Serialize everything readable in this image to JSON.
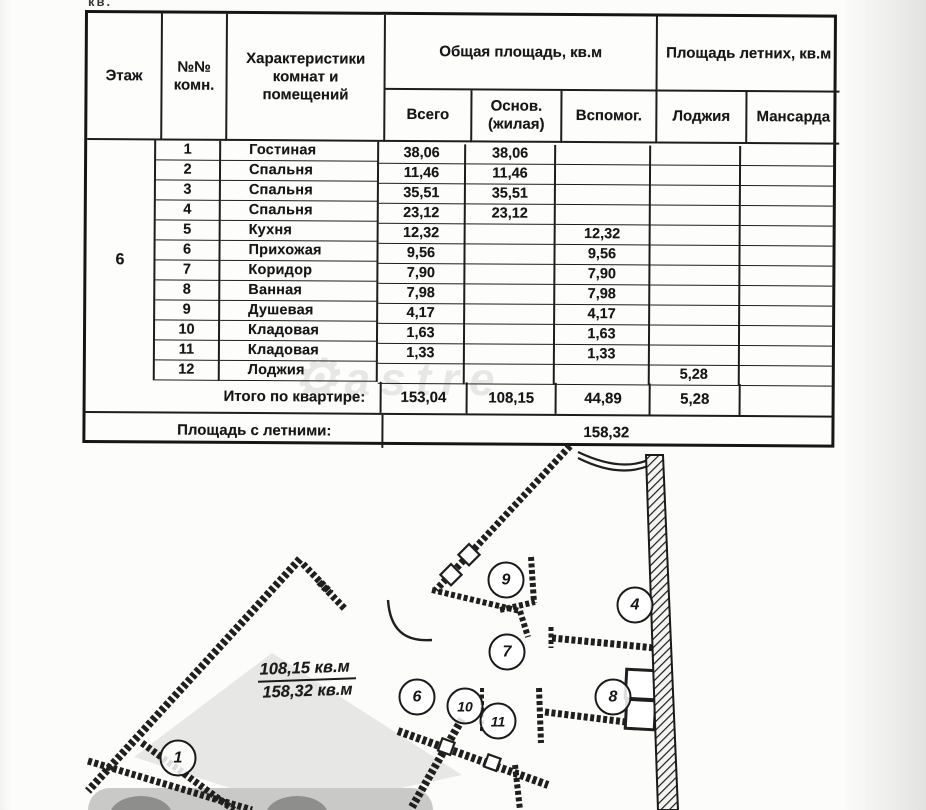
{
  "page": {
    "top_fragment": "кв.",
    "watermark_text": "astre"
  },
  "table": {
    "headers": {
      "floor": "Этаж",
      "room_no": "№№ комн.",
      "characteristics": "Характеристики комнат и помещений",
      "total_area_group": "Общая площадь, кв.м",
      "summer_area_group": "Площадь летних, кв.м",
      "total": "Всего",
      "main": "Основ. (жилая)",
      "auxiliary": "Вспомог.",
      "loggia": "Лоджия",
      "mansard": "Мансарда"
    },
    "floor_value": "6",
    "rows": [
      {
        "no": "1",
        "name": "Гостиная",
        "total": "38,06",
        "main": "38,06",
        "aux": "",
        "loggia": "",
        "mansard": ""
      },
      {
        "no": "2",
        "name": "Спальня",
        "total": "11,46",
        "main": "11,46",
        "aux": "",
        "loggia": "",
        "mansard": ""
      },
      {
        "no": "3",
        "name": "Спальня",
        "total": "35,51",
        "main": "35,51",
        "aux": "",
        "loggia": "",
        "mansard": ""
      },
      {
        "no": "4",
        "name": "Спальня",
        "total": "23,12",
        "main": "23,12",
        "aux": "",
        "loggia": "",
        "mansard": ""
      },
      {
        "no": "5",
        "name": "Кухня",
        "total": "12,32",
        "main": "",
        "aux": "12,32",
        "loggia": "",
        "mansard": ""
      },
      {
        "no": "6",
        "name": "Прихожая",
        "total": "9,56",
        "main": "",
        "aux": "9,56",
        "loggia": "",
        "mansard": ""
      },
      {
        "no": "7",
        "name": "Коридор",
        "total": "7,90",
        "main": "",
        "aux": "7,90",
        "loggia": "",
        "mansard": ""
      },
      {
        "no": "8",
        "name": "Ванная",
        "total": "7,98",
        "main": "",
        "aux": "7,98",
        "loggia": "",
        "mansard": ""
      },
      {
        "no": "9",
        "name": "Душевая",
        "total": "4,17",
        "main": "",
        "aux": "4,17",
        "loggia": "",
        "mansard": ""
      },
      {
        "no": "10",
        "name": "Кладовая",
        "total": "1,63",
        "main": "",
        "aux": "1,63",
        "loggia": "",
        "mansard": ""
      },
      {
        "no": "11",
        "name": "Кладовая",
        "total": "1,33",
        "main": "",
        "aux": "1,33",
        "loggia": "",
        "mansard": ""
      },
      {
        "no": "12",
        "name": "Лоджия",
        "total": "",
        "main": "",
        "aux": "",
        "loggia": "5,28",
        "mansard": ""
      }
    ],
    "totals": {
      "label": "Итого по квартире:",
      "total": "153,04",
      "main": "108,15",
      "aux": "44,89",
      "loggia": "5,28",
      "mansard": ""
    },
    "summer_total": {
      "label": "Площадь с летними:",
      "value": "158,32"
    }
  },
  "plan": {
    "area_label_top": "108,15 кв.м",
    "area_label_bottom": "158,32 кв.м",
    "room_markers": [
      "1",
      "4",
      "6",
      "7",
      "8",
      "9",
      "10",
      "11"
    ]
  }
}
